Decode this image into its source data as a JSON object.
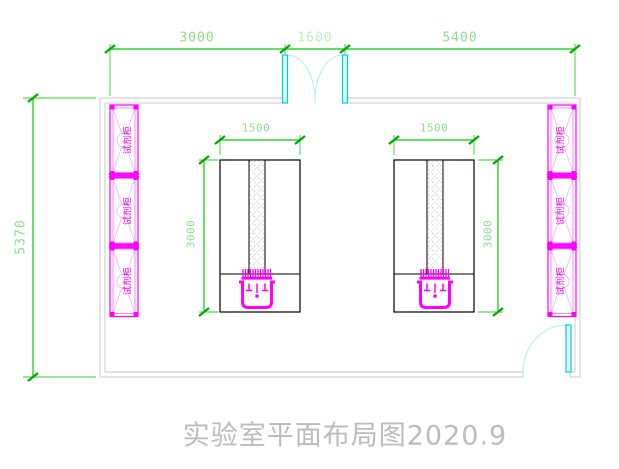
{
  "title": "实验室平面布局图2020.9",
  "dims": {
    "top": [
      "3000",
      "1600",
      "5400"
    ],
    "left": "5370",
    "bench_width_left": "1500",
    "bench_width_right": "1500",
    "bench_depth_left": "3000",
    "bench_depth_right": "3000"
  },
  "cabinets": {
    "left": [
      "试剂柜",
      "试剂柜",
      "试剂柜"
    ],
    "right": [
      "试剂柜",
      "试剂柜",
      "试剂柜"
    ]
  },
  "colors": {
    "dimension_green": "#00cc00",
    "dimension_text_green": "#8fdc8f",
    "wall_gray": "#c9c9c9",
    "furniture_magenta": "#ff00ff",
    "door_cyan": "#00cfcf",
    "bench_black": "#000000",
    "title_gray": "#bcbcbc",
    "background": "#ffffff"
  }
}
